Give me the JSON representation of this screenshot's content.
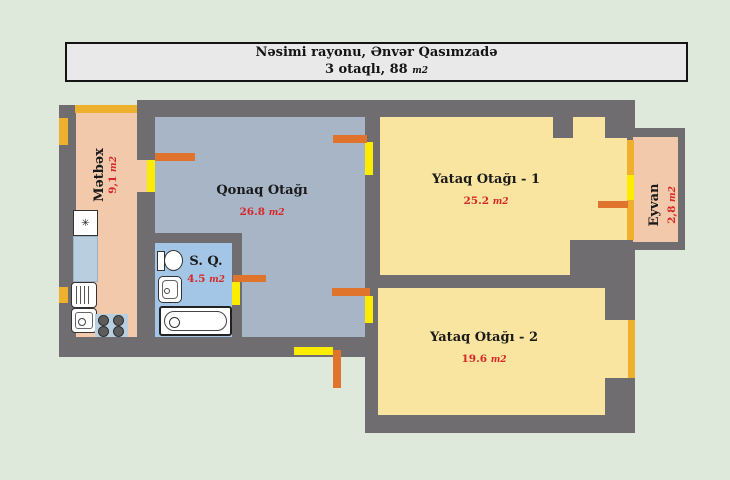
{
  "title": {
    "line1": "Nəsimi rayonu, Ənvər Qasımzadə",
    "line2": "3 otaqlı, 88"
  },
  "unit": "m2",
  "rooms": {
    "kitchen": {
      "name": "Mətbəx",
      "area": "9,1"
    },
    "living": {
      "name": "Qonaq Otağı",
      "area": "26.8"
    },
    "bathroom": {
      "name": "S. Q.",
      "area": "4.5"
    },
    "bedroom1": {
      "name": "Yataq Otağı - 1",
      "area": "25.2"
    },
    "bedroom2": {
      "name": "Yataq Otağı - 2",
      "area": "19.6"
    },
    "balcony": {
      "name": "Eyvan",
      "area": "2,8"
    }
  },
  "icons": {
    "fridge_symbol": "✳",
    "fridge": "fridge-snowflake",
    "stove": "four-burner-stove",
    "kitchen_sink_1": "drainboard-sink",
    "kitchen_sink_2": "basin-sink",
    "toilet": "toilet",
    "washbasin": "washbasin",
    "bathtub": "bathtub"
  },
  "colors": {
    "background": "#dfe9db",
    "wall": "#6f6d70",
    "kitchen": "#f3c9ac",
    "living_room": "#a8b5c6",
    "bathroom": "#a3c6e6",
    "bedroom": "#f9e5a0",
    "balcony": "#f3c9ac",
    "door": "#e0742c",
    "opening": "#fced00",
    "window": "#eeb02d",
    "area_text": "#d62828",
    "counter": "#b9cede",
    "title_background": "#e9e9e9"
  }
}
